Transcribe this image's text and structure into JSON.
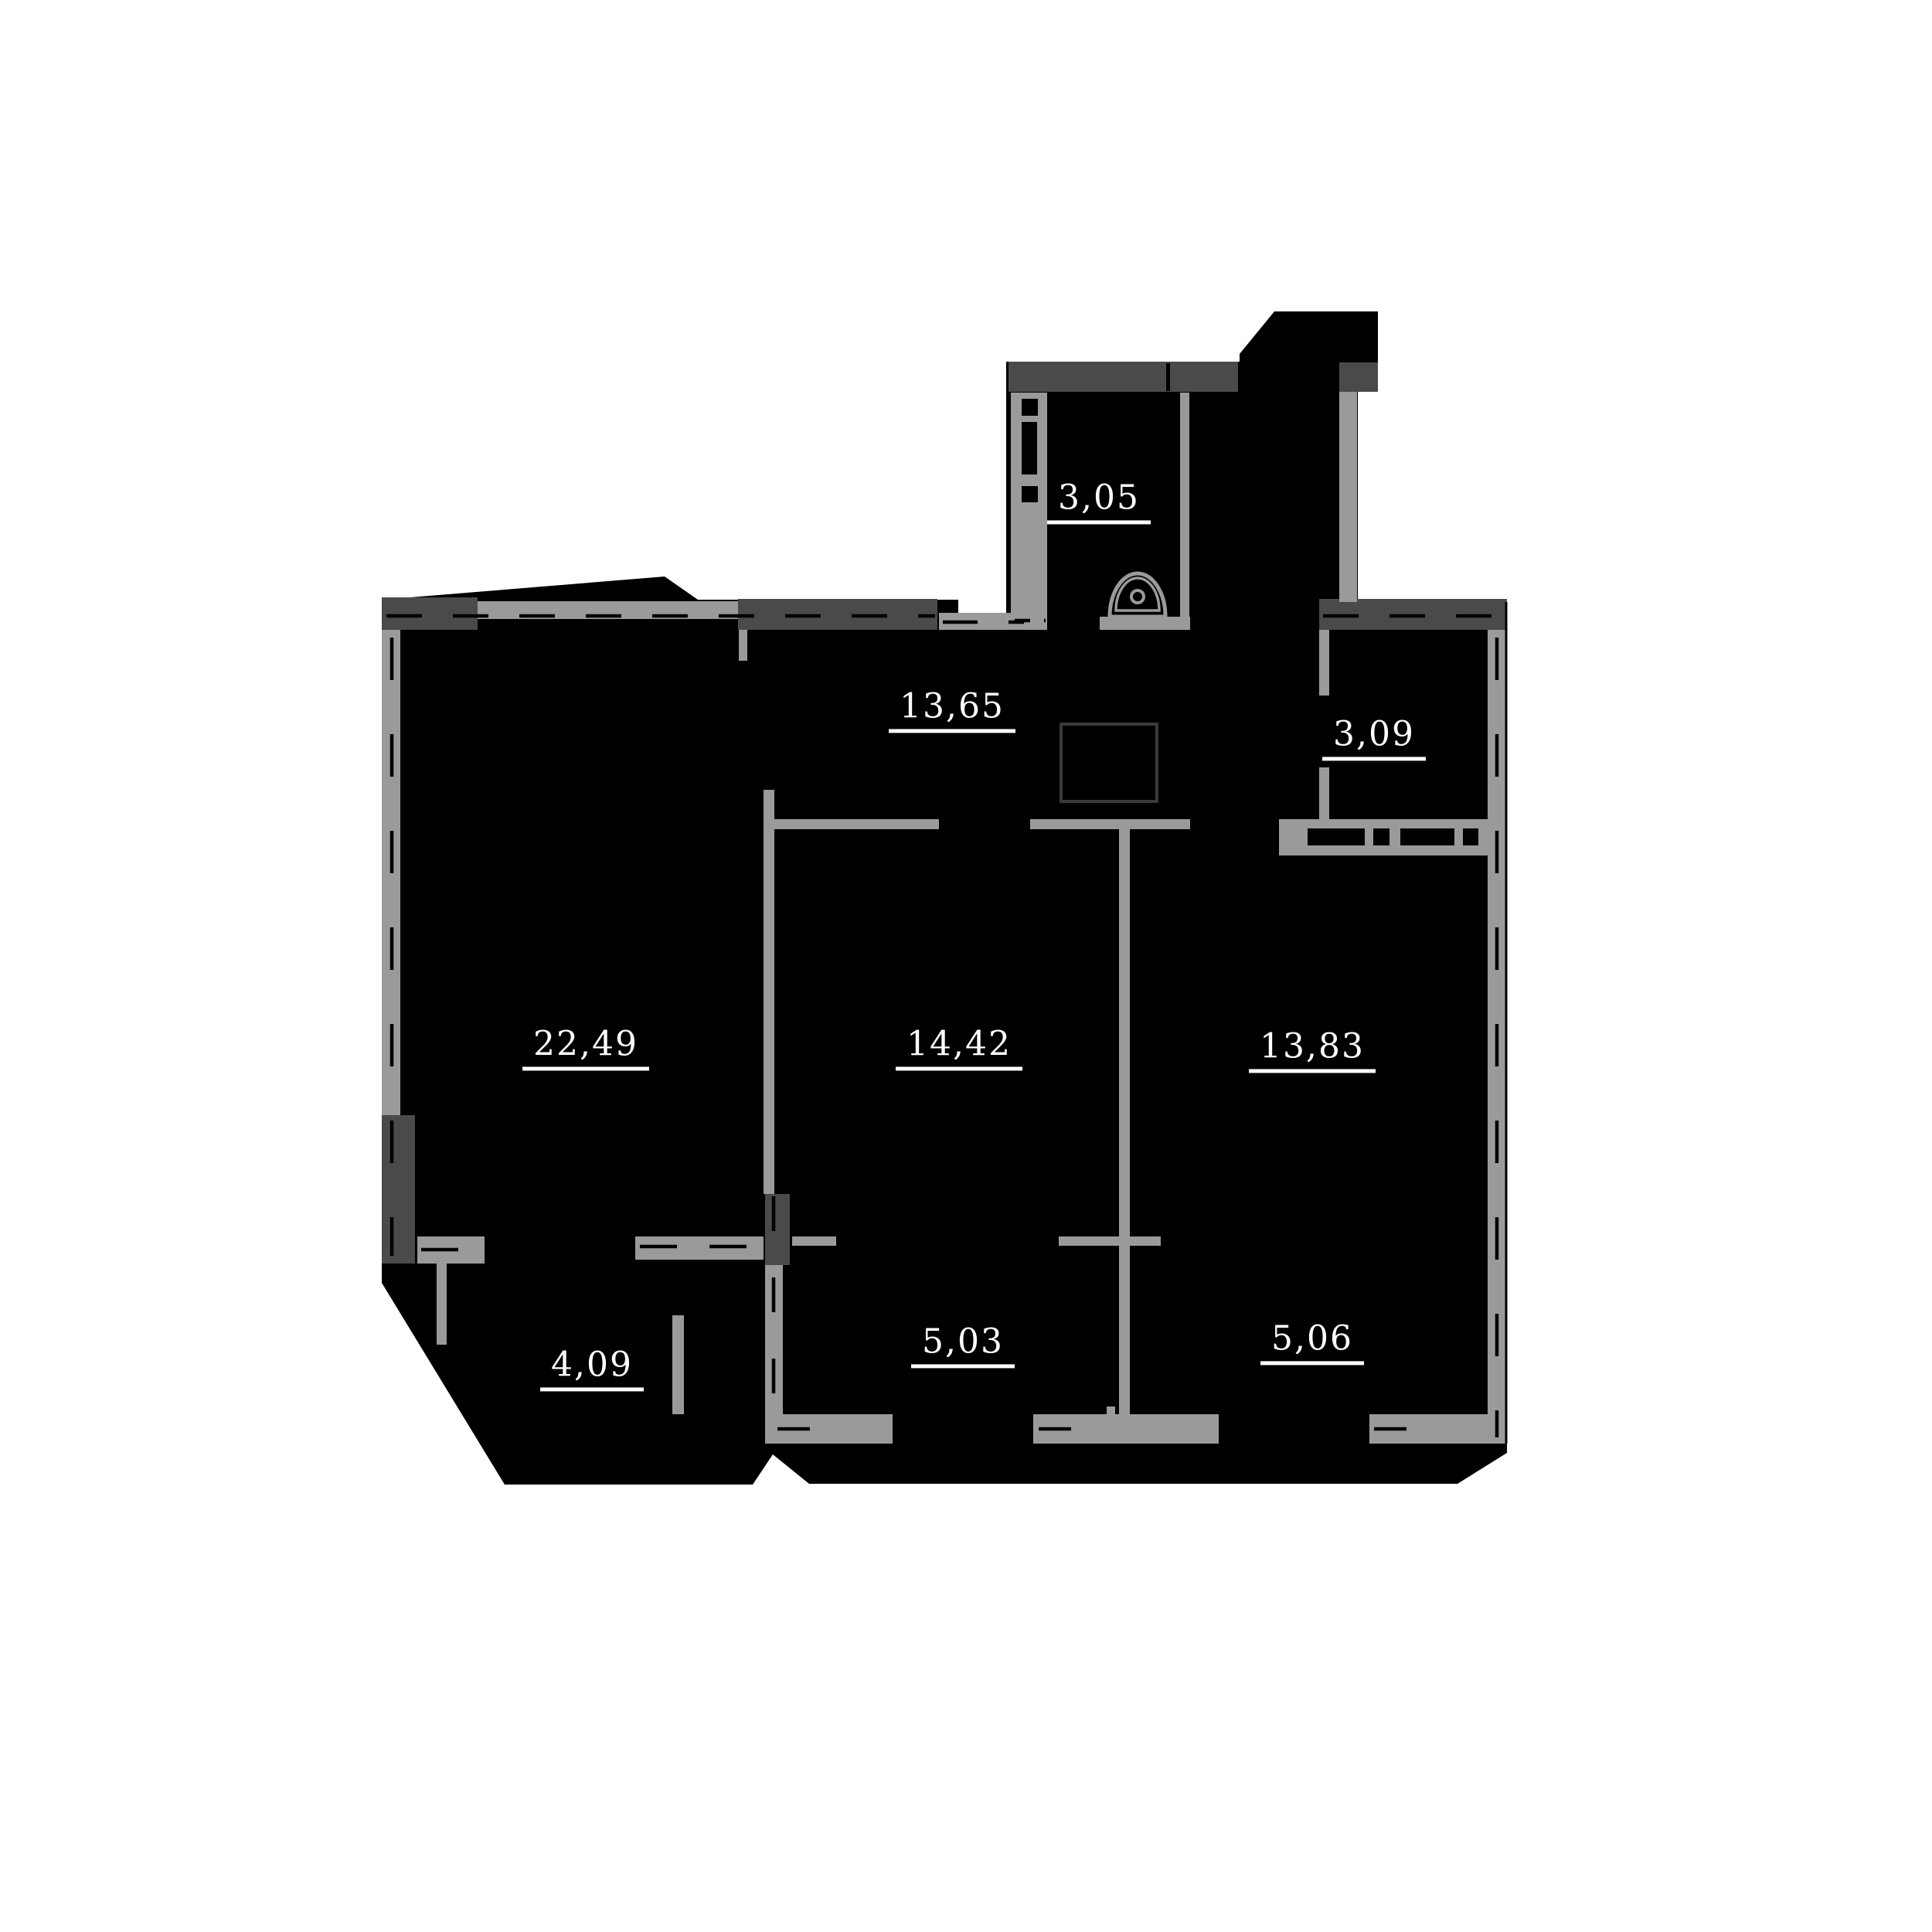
{
  "plan": {
    "title": "apartment-floor-plan",
    "rooms": [
      {
        "area": "3,05"
      },
      {
        "area": "13,65"
      },
      {
        "area": "3,09"
      },
      {
        "area": "22,49"
      },
      {
        "area": "14,42"
      },
      {
        "area": "13,83"
      },
      {
        "area": "4,09"
      },
      {
        "area": "5,03"
      },
      {
        "area": "5,06"
      }
    ],
    "palette": {
      "floor_fill": "#000000",
      "wall_light": "#9a9a9a",
      "wall_dark": "#4a4a4a",
      "duct_outline": "#3a3a3a",
      "label_color": "#ffffff",
      "background": "#ffffff"
    },
    "icons": [
      "sink-icon"
    ]
  }
}
